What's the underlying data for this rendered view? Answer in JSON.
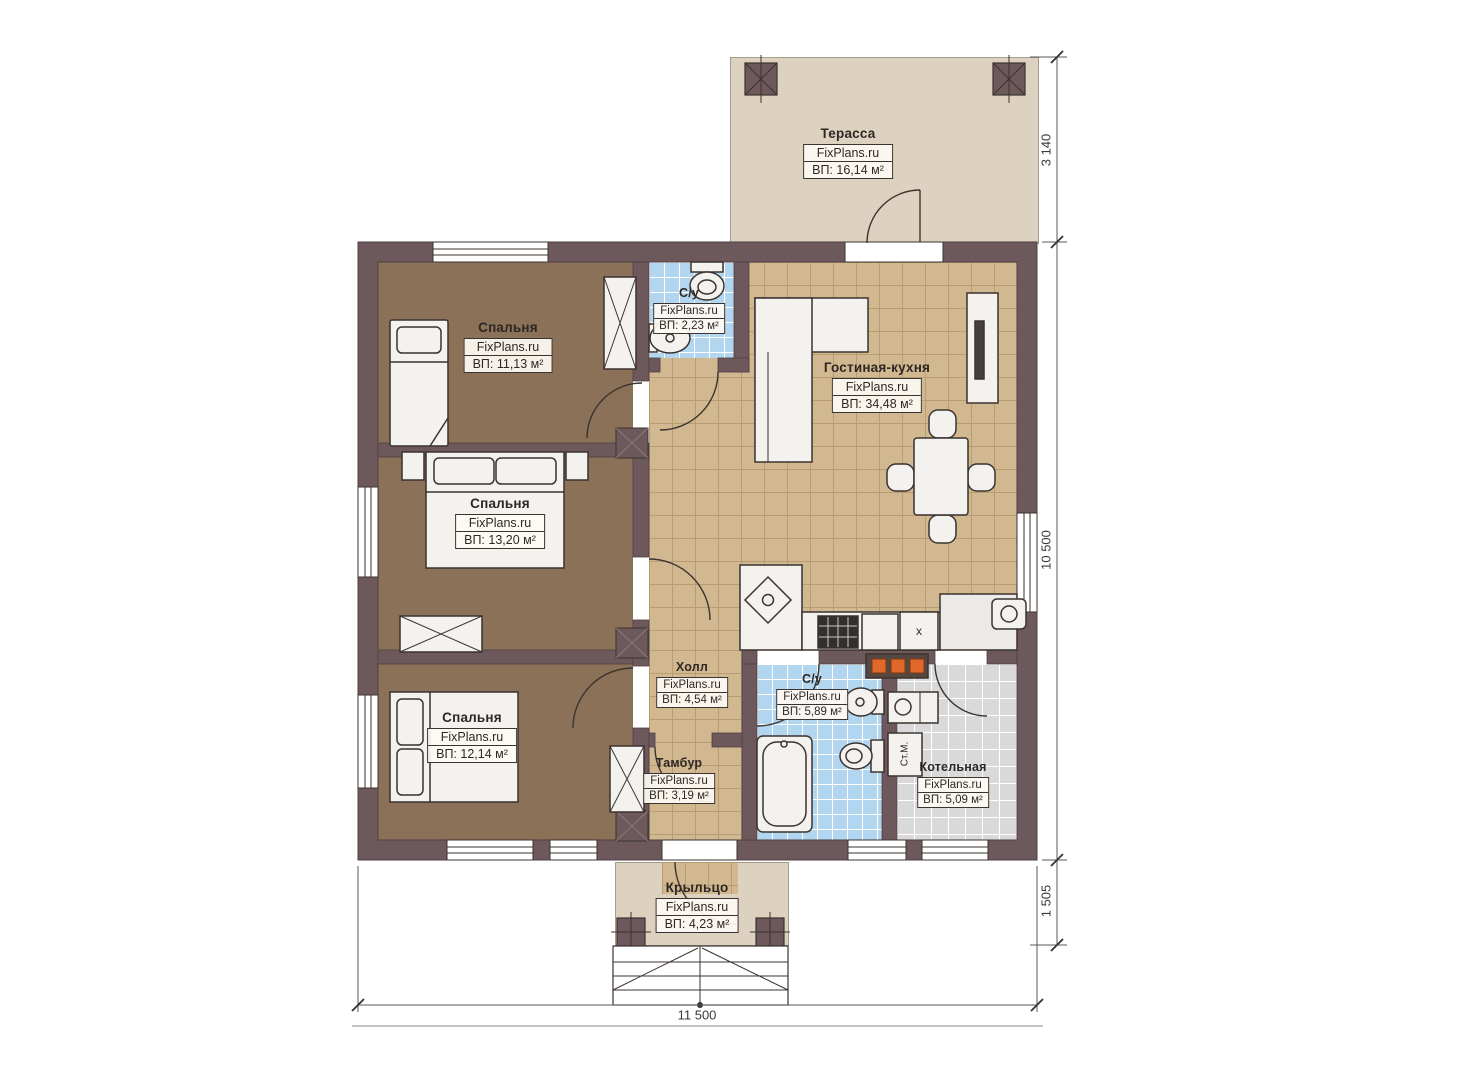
{
  "meta": {
    "brand": "FixPlans.ru",
    "plan_type": "floor-plan"
  },
  "rooms": {
    "terrace": {
      "name": "Терасса",
      "brand": "FixPlans.ru",
      "area": "ВП: 16,14 м²"
    },
    "bedroom_top": {
      "name": "Спальня",
      "brand": "FixPlans.ru",
      "area": "ВП: 11,13 м²"
    },
    "bedroom_mid": {
      "name": "Спальня",
      "brand": "FixPlans.ru",
      "area": "ВП: 13,20 м²"
    },
    "bedroom_bot": {
      "name": "Спальня",
      "brand": "FixPlans.ru",
      "area": "ВП: 12,14 м²"
    },
    "wc_top": {
      "name": "С/у",
      "brand": "FixPlans.ru",
      "area": "ВП: 2,23 м²"
    },
    "living": {
      "name": "Гостиная-кухня",
      "brand": "FixPlans.ru",
      "area": "ВП: 34,48 м²"
    },
    "hall": {
      "name": "Холл",
      "brand": "FixPlans.ru",
      "area": "ВП: 4,54 м²"
    },
    "wc_bot": {
      "name": "С/у",
      "brand": "FixPlans.ru",
      "area": "ВП: 5,89 м²"
    },
    "tambour": {
      "name": "Тамбур",
      "brand": "FixPlans.ru",
      "area": "ВП: 3,19 м²"
    },
    "boiler": {
      "name": "Котельная",
      "brand": "FixPlans.ru",
      "area": "ВП: 5,09 м²"
    },
    "porch": {
      "name": "Крыльцо",
      "brand": "FixPlans.ru",
      "area": "ВП: 4,23 м²"
    }
  },
  "dimensions": {
    "terrace_depth": "3 140",
    "house_depth": "10 500",
    "porch_depth": "1 505",
    "house_width": "11 500"
  },
  "annotations": {
    "washing_machine": "Ст.М.",
    "kitchen_unit": "x"
  },
  "colors": {
    "wall": "#6d585b",
    "bedroom_floor": "#8b7157",
    "living_floor": "#d1b890",
    "bathroom_floor": "#b2d6f0",
    "boiler_floor": "#d9d9d9",
    "terrace_floor": "#ddd2c0",
    "outline": "#3b332f",
    "radiator_accent": "#e2672a"
  }
}
